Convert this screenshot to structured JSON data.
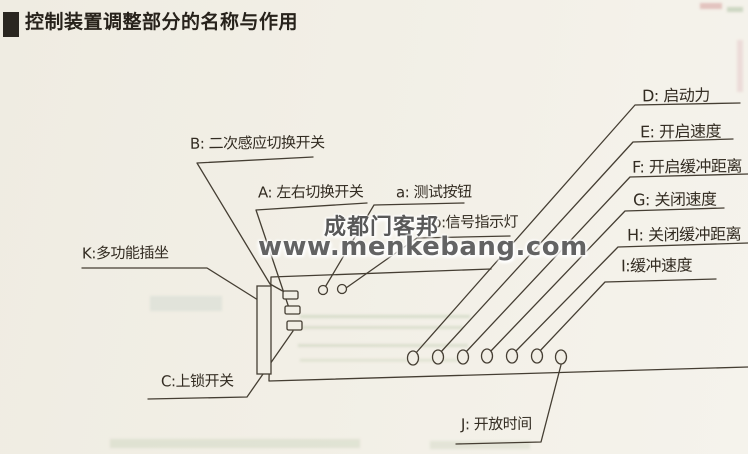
{
  "title": {
    "text": "控制装置调整部分的名称与作用"
  },
  "watermark": {
    "line1": "成都门客邦",
    "line2": "www.menkebang.com"
  },
  "callouts": {
    "B": "B: 二次感应切换开关",
    "A": "A: 左右切换开关",
    "a_btn": "a: 测试按钮",
    "b_lamp": "b:信号指示灯",
    "K": "K:多功能插坐",
    "C": "C:上锁开关",
    "J": "J: 开放时间",
    "D": "D: 启动力",
    "E": "E: 开启速度",
    "F": "F: 开启缓冲距离",
    "G": "G: 关闭速度",
    "H": "H: 关闭缓冲距离",
    "I": "I:缓冲速度"
  },
  "colors": {
    "paper": "#f1eee5",
    "ink": "#2a2620",
    "line": "#453e33",
    "watermark_gray": "#585858"
  }
}
